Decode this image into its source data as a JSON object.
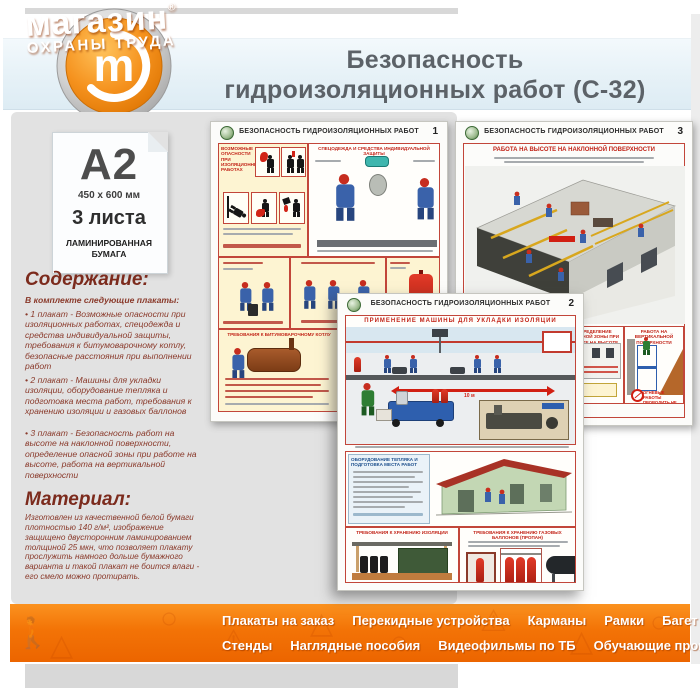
{
  "colors": {
    "accent_orange": "#f37306",
    "maroon_text": "#8a3a2b",
    "header_blue": "#e6f1f7",
    "poster_red": "#c22418"
  },
  "header": {
    "title_line1": "Безопасность",
    "title_line2": "гидроизоляционных работ (С-32)",
    "logo_letter": "m"
  },
  "sidebar": {
    "format": "A2",
    "size": "450 x 600 мм",
    "sheets": "3 листа",
    "paper_type_line1": "ЛАМИНИРОВАННАЯ",
    "paper_type_line2": "БУМАГА",
    "contents_heading": "Содержание:",
    "contents_intro": "В комплекте следующие плакаты:",
    "contents_items": [
      "• 1 плакат - Возможные опасности при изоляционных работах, спецодежда и средства индивидуальной защиты, требования к битумоварочному котлу, безопасные расстояния при выполнении работ",
      "• 2 плакат - Машины для укладки изоляции, оборудование тепляка и подготовка места работ, требования к хранению изоляции и газовых баллонов",
      "• 3 плакат - Безопасность работ на высоте на наклонной поверхности, определение опасной зоны при работе на высоте, работа на вертикальной поверхности"
    ],
    "material_heading": "Материал:",
    "material_text": "Изготовлен из качественной белой бумаги плотностью 140 г/м², изображение защищено двусторонним ламинированием толщиной 25 мкн, что позволяет плакату прослужить намного дольше бумажного варианта и такой плакат не боится влаги - его смело можно протирать."
  },
  "posters": {
    "common_title": "БЕЗОПАСНОСТЬ ГИДРОИЗОЛЯЦИОННЫХ РАБОТ",
    "poster1": {
      "number": "1",
      "hazards_title": "ВОЗМОЖНЫЕ ОПАСНОСТИ ПРИ ИЗОЛЯЦИОННЫХ РАБОТАХ",
      "ppe_title": "СПЕЦОДЕЖДА И СРЕДСТВА ИНДИВИДУАЛЬНОЙ ЗАЩИТЫ",
      "boiler_title": "ТРЕБОВАНИЯ К БИТУМОВАРОЧНОМУ КОТЛУ"
    },
    "poster2": {
      "number": "2",
      "machine_title": "ПРИМЕНЕНИЕ МАШИНЫ ДЛЯ УКЛАДКИ ИЗОЛЯЦИИ",
      "distance_label": "10 м",
      "teplyak_title": "ОБОРУДОВАНИЕ ТЕПЛЯКА И ПОДГОТОВКА МЕСТА РАБОТ",
      "insulation_storage_title": "ТРЕБОВАНИЯ К ХРАНЕНИЮ ИЗОЛЯЦИИ",
      "cylinder_storage_title": "ТРЕБОВАНИЯ К ХРАНЕНИЮ ГАЗОВЫХ БАЛЛОНОВ (ПРОПАН)"
    },
    "poster3": {
      "number": "3",
      "slope_title": "РАБОТА НА ВЫСОТЕ НА НАКЛОННОЙ ПОВЕРХНОСТИ",
      "trap_label": "КОНСТРУКЦИЯ ТРАПА",
      "fence_label": "ЗАЩИТНОЕ ОГРАЖДЕНИЕ",
      "danger_zone_title": "ОПРЕДЕЛЕНИЕ ОПАСНОЙ ЗОНЫ ПРИ РАБОТЕ НА ВЫСОТЕ",
      "vertical_title": "РАБОТА НА ВЕРТИКАЛЬНОЙ ПОВЕРХНОСТИ",
      "fire_warning": "ОГНЕВЫЕ РАБОТЫ ПРОВОДИТЬ НЕ БЛИЖЕ 50 М"
    }
  },
  "footer": {
    "logo_line1": "магазин",
    "logo_reg": "®",
    "logo_line2": "ОХРАНЫ ТРУДА",
    "menu_row1": [
      "Плакаты на заказ",
      "Перекидные устройства",
      "Карманы",
      "Рамки",
      "Багет"
    ],
    "menu_row2": [
      "Стенды",
      "Наглядные пособия",
      "Видеофильмы по ТБ",
      "Обучающие программы"
    ]
  }
}
